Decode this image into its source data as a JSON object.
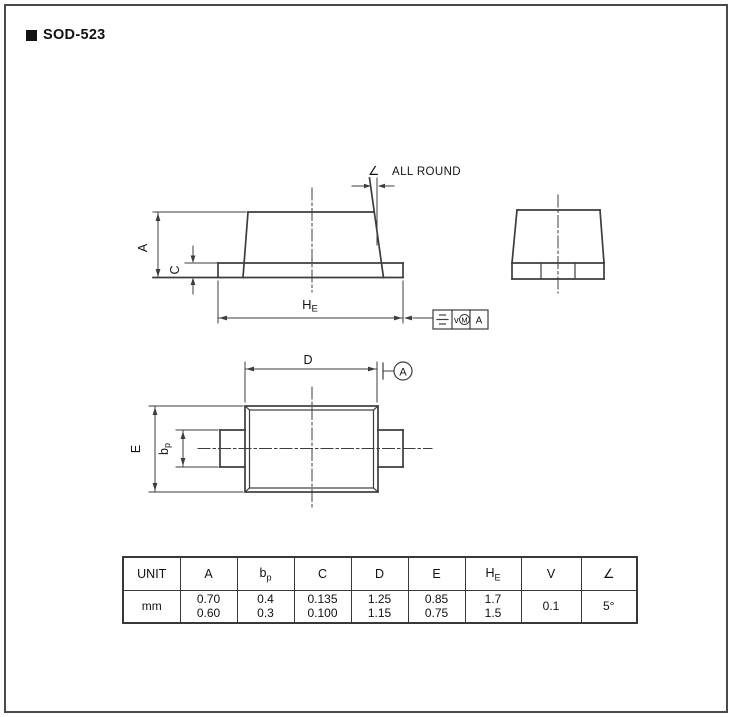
{
  "title": "SOD-523",
  "front_view": {
    "dim_a": "A",
    "dim_c": "C",
    "dim_he": {
      "main": "H",
      "sub": "E"
    },
    "angle_glyph": "∠",
    "all_round_label": "ALL ROUND",
    "fcf": {
      "tolerance_var": "v",
      "material_modifier": "M",
      "datum_ref": "A"
    }
  },
  "top_view": {
    "dim_d": "D",
    "dim_e": "E",
    "dim_bp": {
      "main": "b",
      "sub": "p"
    },
    "datum_label": "A"
  },
  "dimension_table": {
    "headers": [
      {
        "main": "UNIT"
      },
      {
        "main": "A"
      },
      {
        "main": "b",
        "sub": "p"
      },
      {
        "main": "C"
      },
      {
        "main": "D"
      },
      {
        "main": "E"
      },
      {
        "main": "H",
        "sub": "E"
      },
      {
        "main": "V"
      },
      {
        "main": "∠"
      }
    ],
    "row": {
      "unit": "mm",
      "a": {
        "max": "0.70",
        "min": "0.60"
      },
      "bp": {
        "max": "0.4",
        "min": "0.3"
      },
      "c": {
        "max": "0.135",
        "min": "0.100"
      },
      "d": {
        "max": "1.25",
        "min": "1.15"
      },
      "e": {
        "max": "0.85",
        "min": "0.75"
      },
      "he": {
        "max": "1.7",
        "min": "1.5"
      },
      "v": "0.1",
      "angle": "5°"
    }
  },
  "colors": {
    "line": "#3d3d3d",
    "text": "#141414",
    "background": "#ffffff",
    "page_border": "#4a4a4a"
  }
}
